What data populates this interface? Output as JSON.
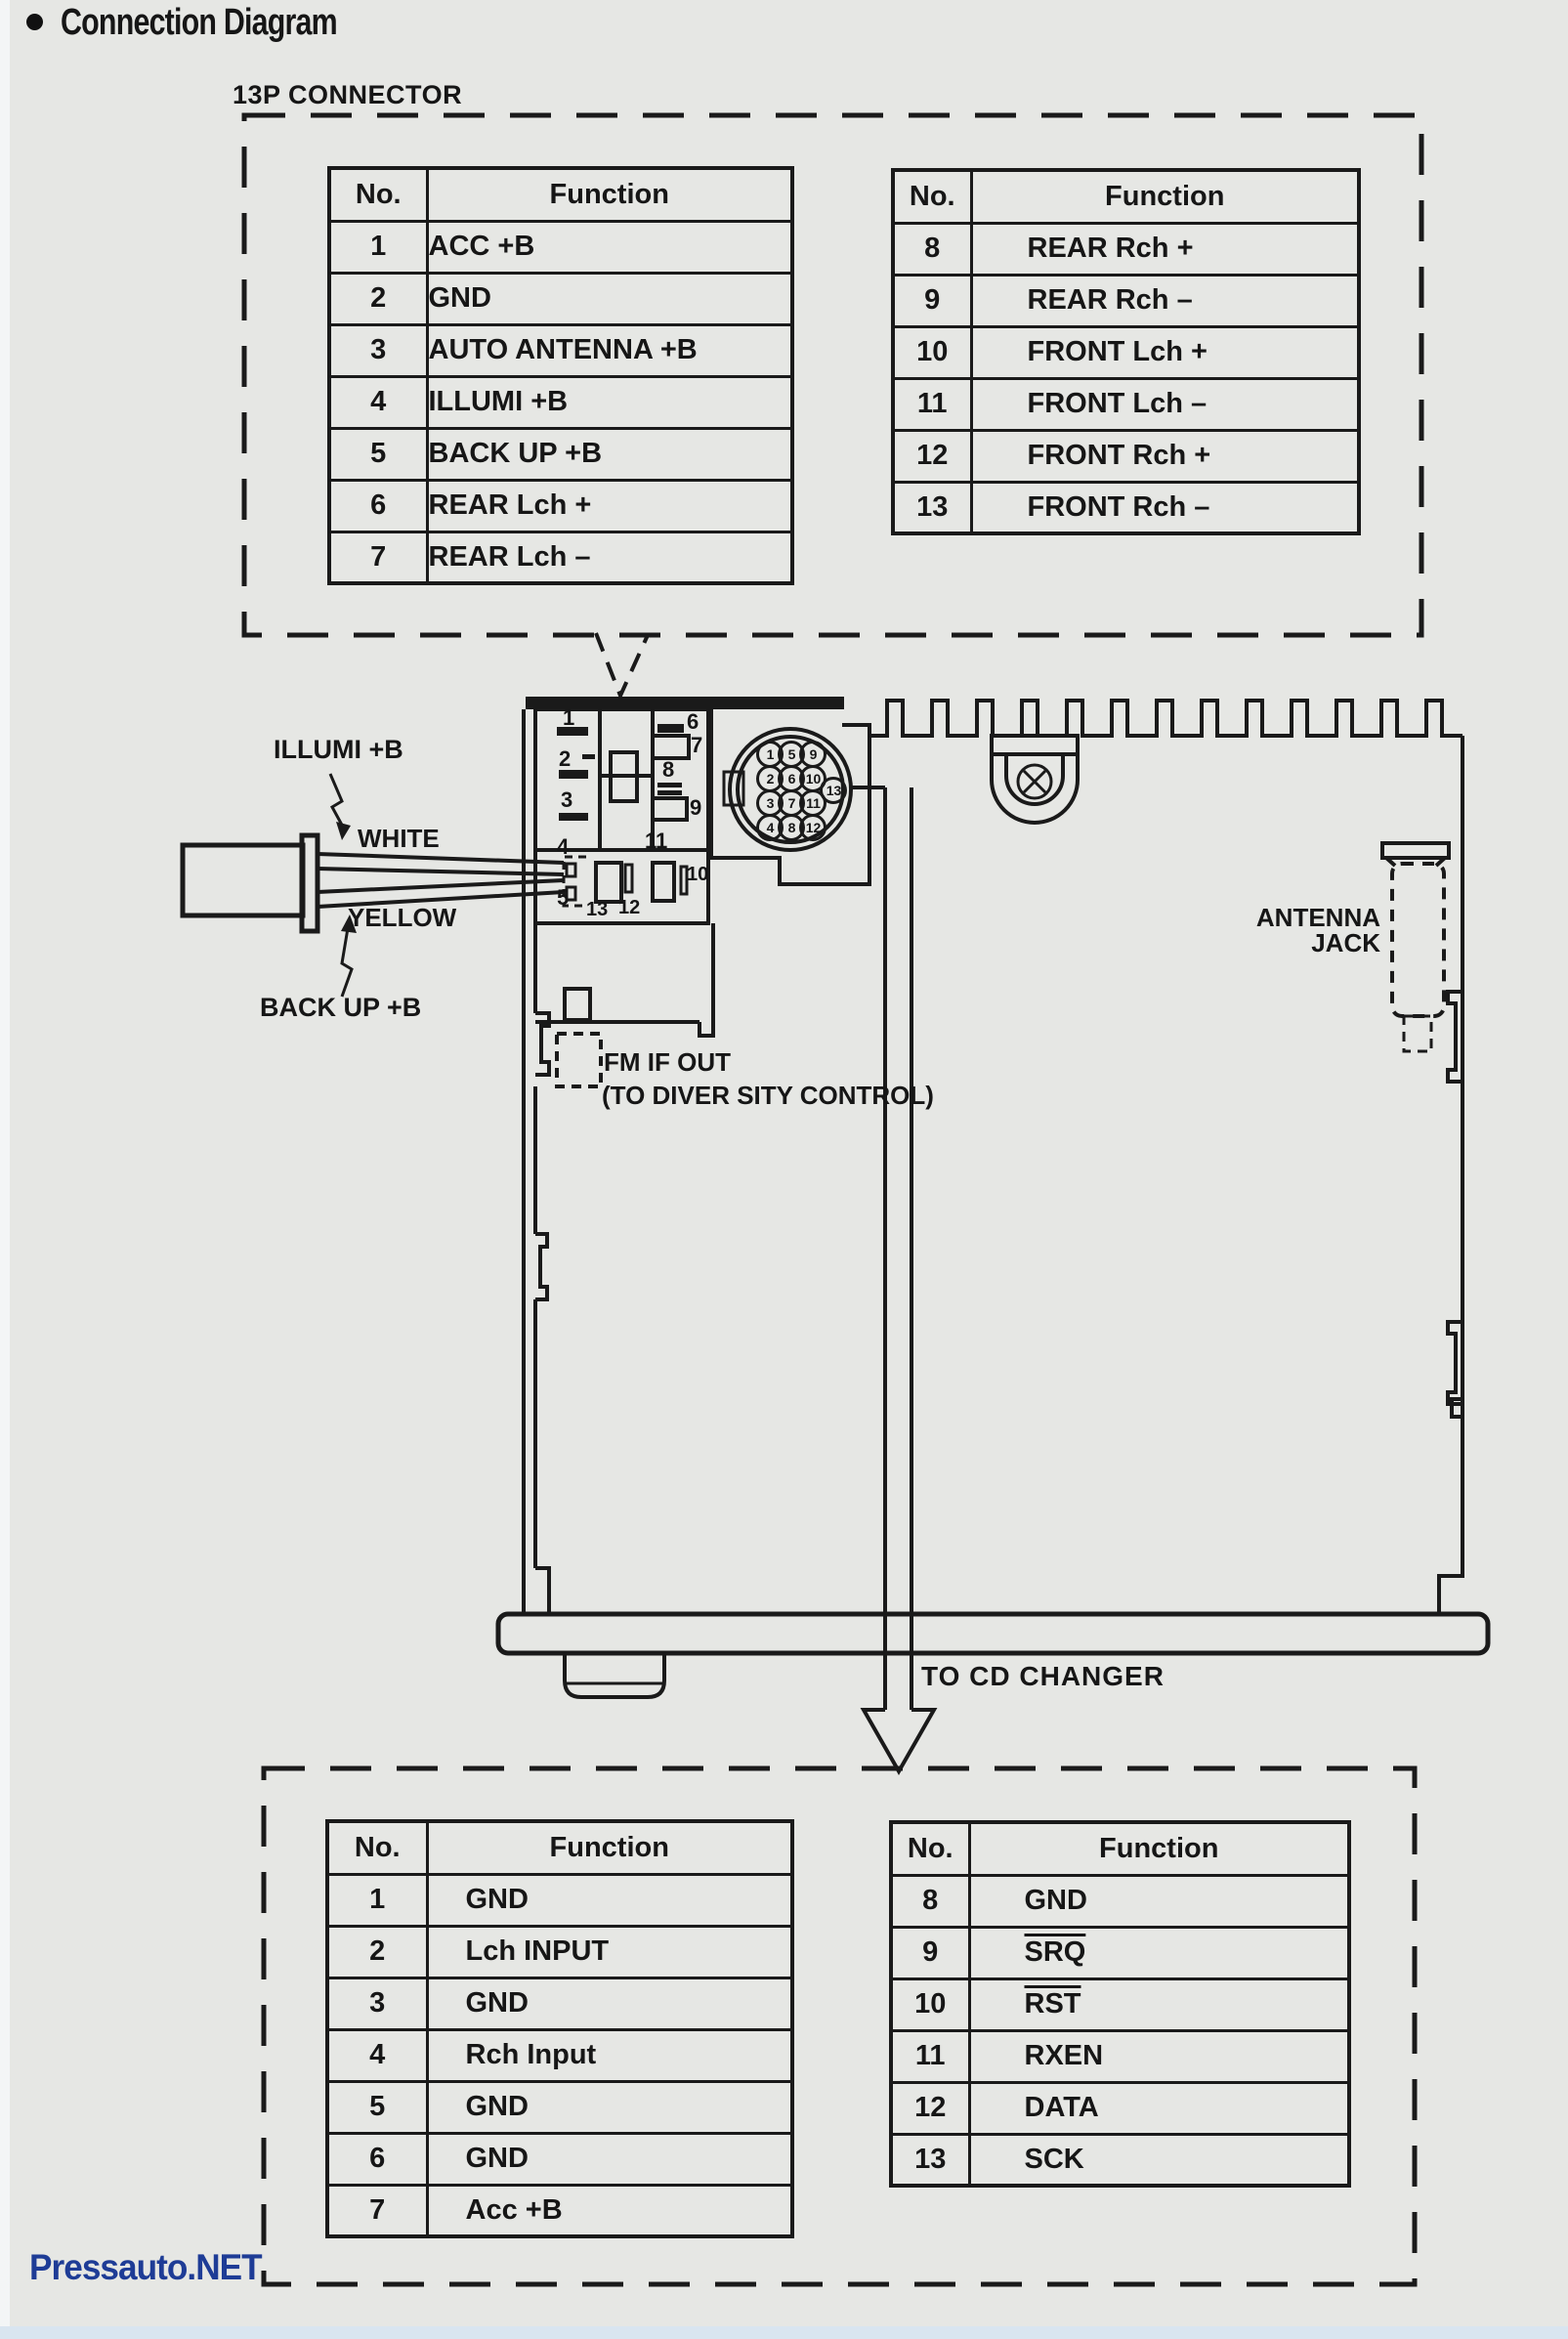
{
  "page": {
    "title": "Connection Diagram",
    "watermark": "Pressauto.NET",
    "colors": {
      "background": "#e6e7e4",
      "ink": "#1a1a1a",
      "watermark_blue": "#1e3c96"
    }
  },
  "top_section": {
    "label": "13P CONNECTOR",
    "left_table": {
      "headers": [
        "No.",
        "Function"
      ],
      "rows": [
        [
          "1",
          "ACC +B"
        ],
        [
          "2",
          "GND"
        ],
        [
          "3",
          "AUTO ANTENNA +B"
        ],
        [
          "4",
          "ILLUMI +B"
        ],
        [
          "5",
          "BACK UP +B"
        ],
        [
          "6",
          "REAR Lch +"
        ],
        [
          "7",
          "REAR Lch –"
        ]
      ]
    },
    "right_table": {
      "headers": [
        "No.",
        "Function"
      ],
      "rows": [
        [
          "8",
          "REAR Rch +"
        ],
        [
          "9",
          "REAR Rch –"
        ],
        [
          "10",
          "FRONT Lch +"
        ],
        [
          "11",
          "FRONT Lch –"
        ],
        [
          "12",
          "FRONT Rch +"
        ],
        [
          "13",
          "FRONT Rch –"
        ]
      ]
    }
  },
  "diagram": {
    "labels": {
      "illumi": "ILLUMI +B",
      "white": "WHITE",
      "yellow": "YELLOW",
      "backup": "BACK UP +B",
      "fm_if_out": "FM IF OUT",
      "diversity": "(TO DIVER SITY CONTROL)",
      "antenna_line1": "ANTENNA",
      "antenna_line2": "JACK",
      "to_cd_changer": "TO CD CHANGER"
    },
    "block_pins": [
      "1",
      "2",
      "3",
      "6",
      "7",
      "8",
      "9",
      "4",
      "5",
      "13",
      "12",
      "11",
      "10"
    ],
    "round_pins": [
      "1",
      "5",
      "9",
      "2",
      "6",
      "10",
      "13",
      "3",
      "7",
      "11",
      "4",
      "8",
      "12"
    ]
  },
  "bottom_section": {
    "left_table": {
      "headers": [
        "No.",
        "Function"
      ],
      "rows": [
        [
          "1",
          "GND"
        ],
        [
          "2",
          "Lch INPUT"
        ],
        [
          "3",
          "GND"
        ],
        [
          "4",
          "Rch Input"
        ],
        [
          "5",
          "GND"
        ],
        [
          "6",
          "GND"
        ],
        [
          "7",
          "Acc +B"
        ]
      ]
    },
    "right_table": {
      "headers": [
        "No.",
        "Function"
      ],
      "rows": [
        [
          "8",
          "GND"
        ],
        [
          "9",
          "SRQ"
        ],
        [
          "10",
          "RST"
        ],
        [
          "11",
          "RXEN"
        ],
        [
          "12",
          "DATA"
        ],
        [
          "13",
          "SCK"
        ]
      ]
    }
  }
}
